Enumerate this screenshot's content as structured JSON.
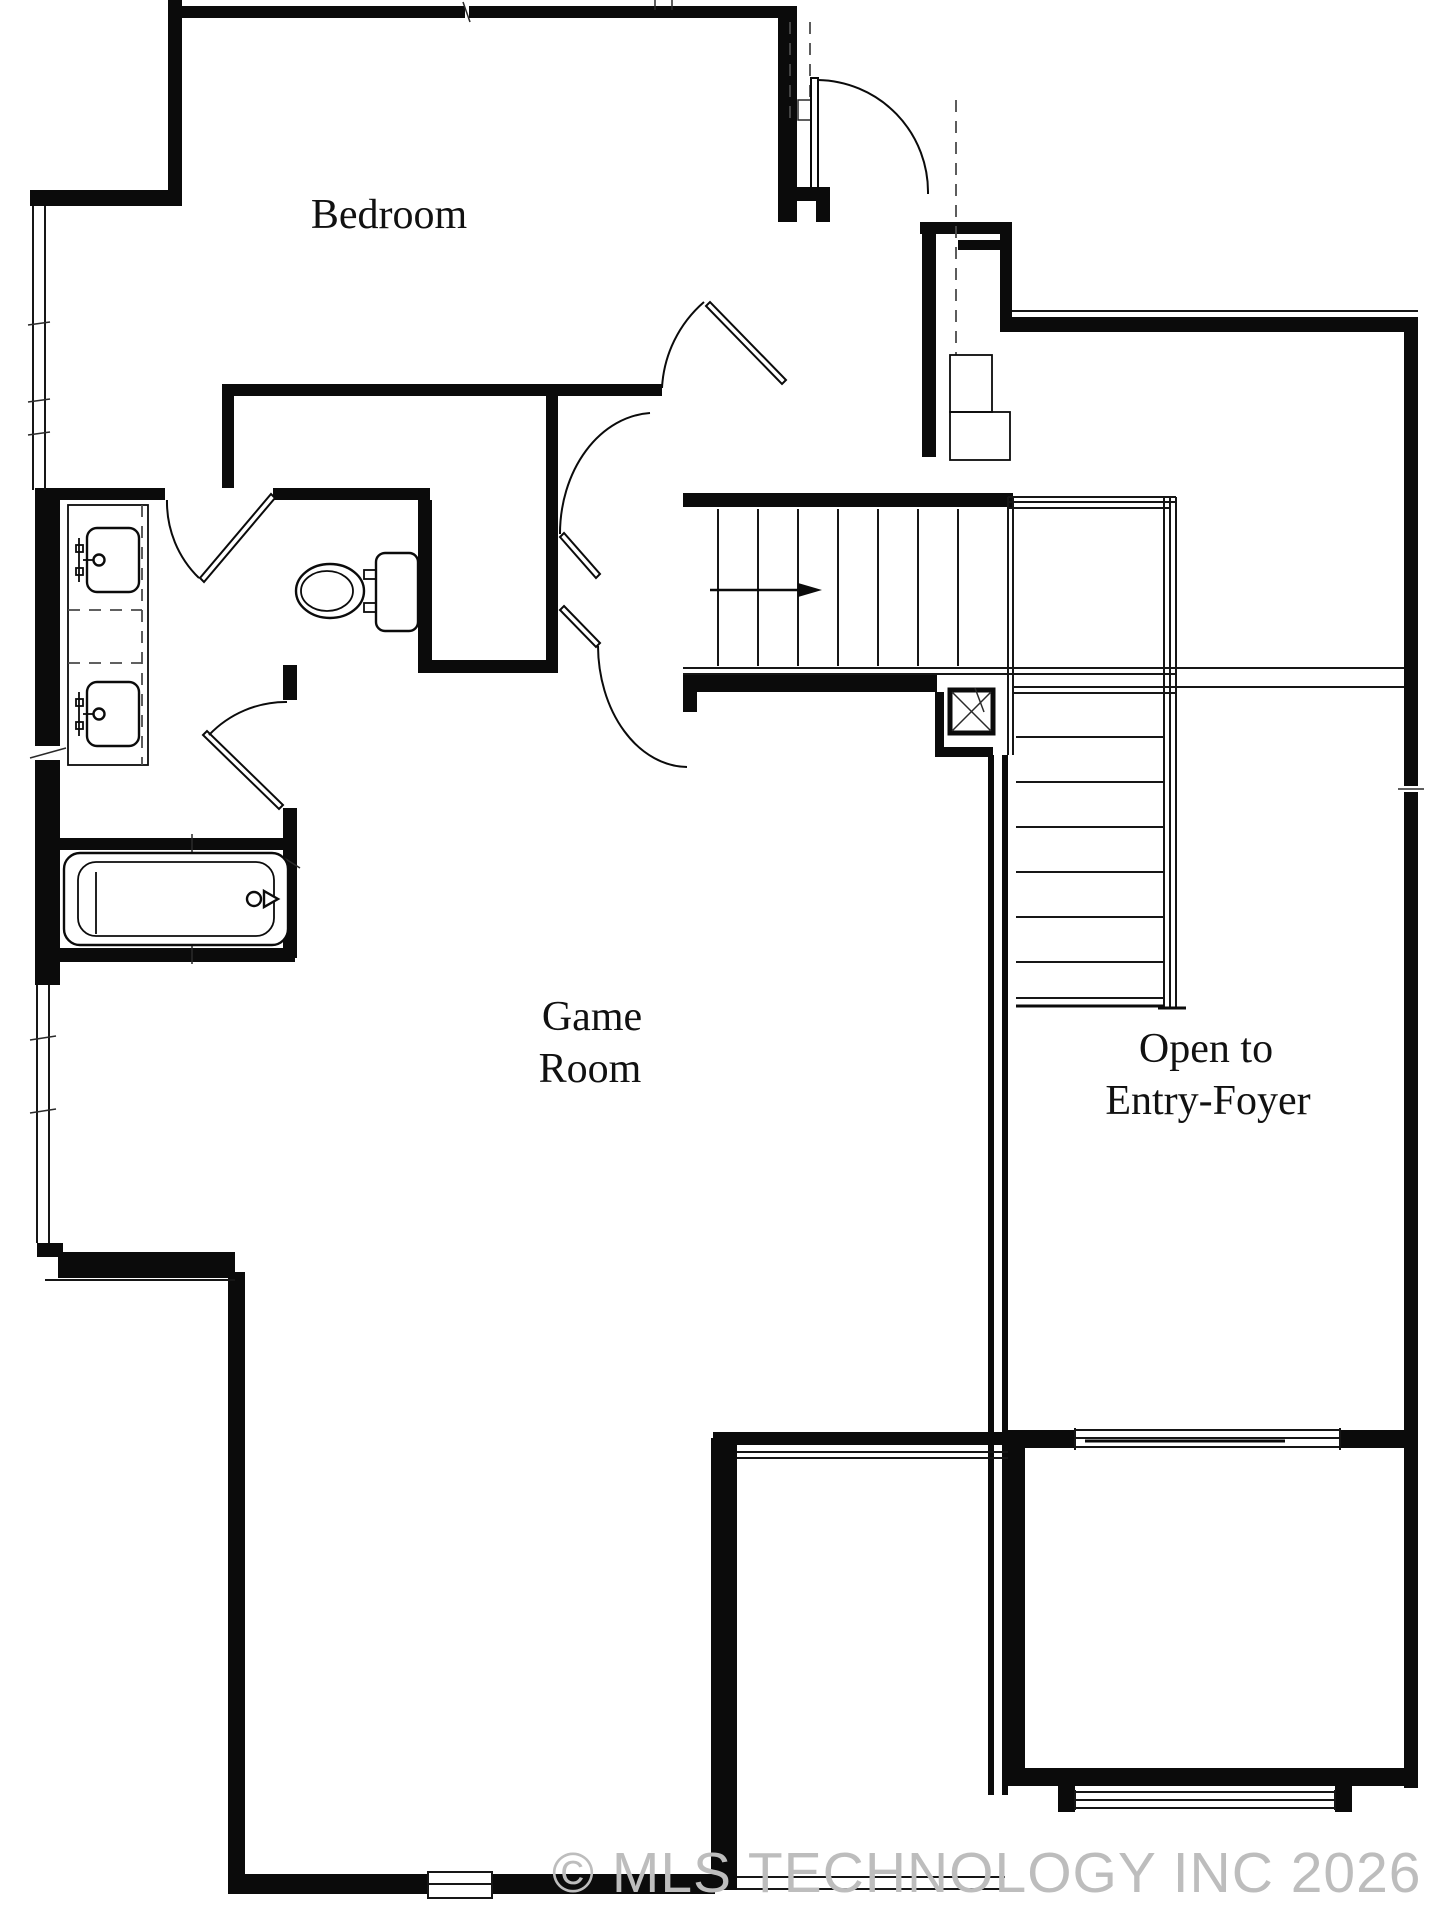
{
  "document": {
    "type": "architectural floor plan",
    "background_color": "#ffffff",
    "wall_color": "#0b0b0b",
    "line_color": "#161616"
  },
  "labels": {
    "bedroom": "Bedroom",
    "game_room_line1": "Game",
    "game_room_line2": "Room",
    "foyer_line1": "Open to",
    "foyer_line2": "Entry-Foyer"
  },
  "watermark": {
    "text": "© MLS TECHNOLOGY INC 2026",
    "color": "#bdbdbd"
  },
  "fixtures": {
    "sinks": 2,
    "toilet": 1,
    "bathtub": 1,
    "icon_names": [
      "sink-icon",
      "toilet-icon",
      "bathtub-icon",
      "stairs-icon",
      "door-swing-icon",
      "window-icon",
      "newel-post-icon"
    ]
  },
  "stairs": {
    "upper_flight_treads": 7,
    "lower_flight_treads": 8,
    "direction_arrow": "right"
  }
}
